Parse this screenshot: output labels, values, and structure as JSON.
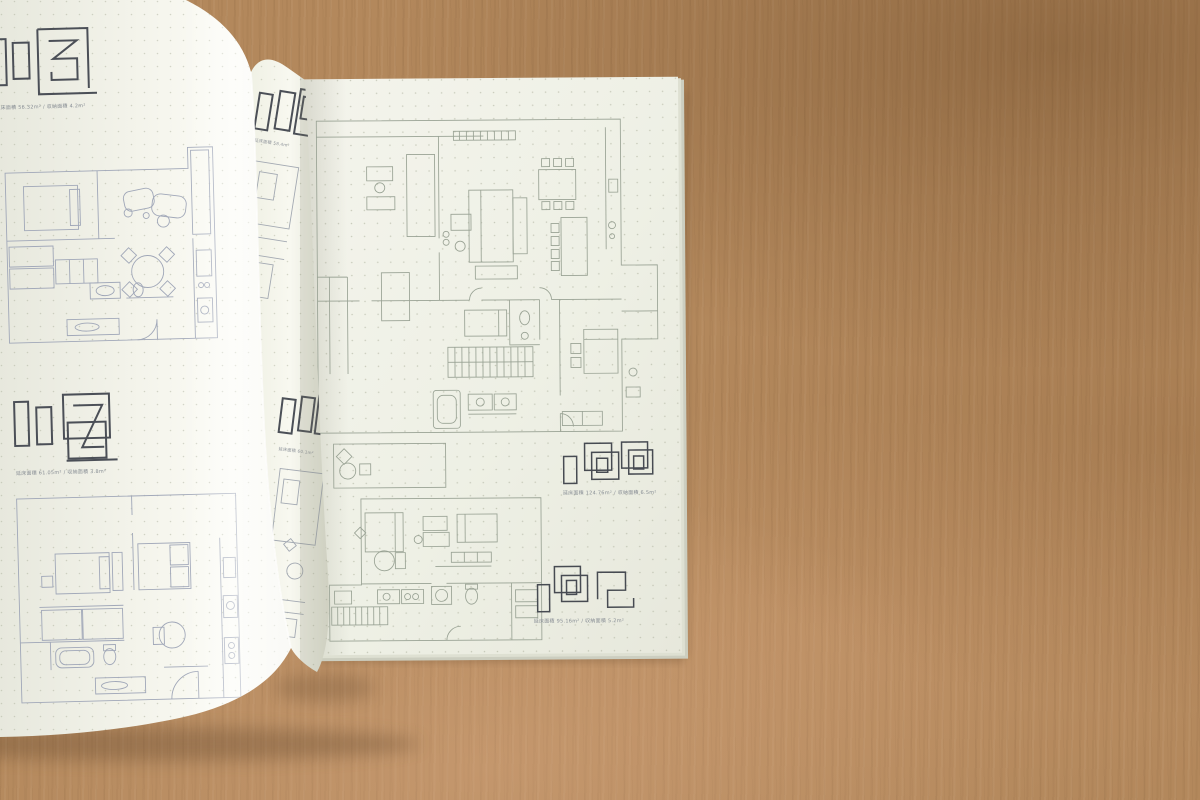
{
  "book": {
    "left_page": {
      "units": [
        {
          "unit_number": "113",
          "caption": "延床面積 56.32m² / 収納面積 4.2m²"
        },
        {
          "unit_number": "117",
          "caption": "延床面積 61.05m² / 収納面積 3.8m²"
        }
      ]
    },
    "middle_page": {
      "units": [
        {
          "caption": "延床面積 58.4m²"
        },
        {
          "caption": "延床面積 60.1m²"
        }
      ]
    },
    "right_page": {
      "units": [
        {
          "unit_number": "100",
          "caption": "延床面積 124.76m² / 収納面積 6.5m²"
        },
        {
          "unit_number": "102",
          "caption": "延床面積 95.16m² / 収納面積 5.2m²"
        }
      ]
    },
    "colors": {
      "wood_base": "#b3885c",
      "wood_dark": "#9c7347",
      "wood_light": "#cfa37c",
      "page": "#eff0e6",
      "page_bright": "#fbfbf5",
      "plan_line_left": "#a0a7b8",
      "plan_line_right": "#99a294",
      "logo_line": "#4b4f57",
      "dot_grid": "#a8aa96",
      "caption_text": "#878d94"
    }
  }
}
